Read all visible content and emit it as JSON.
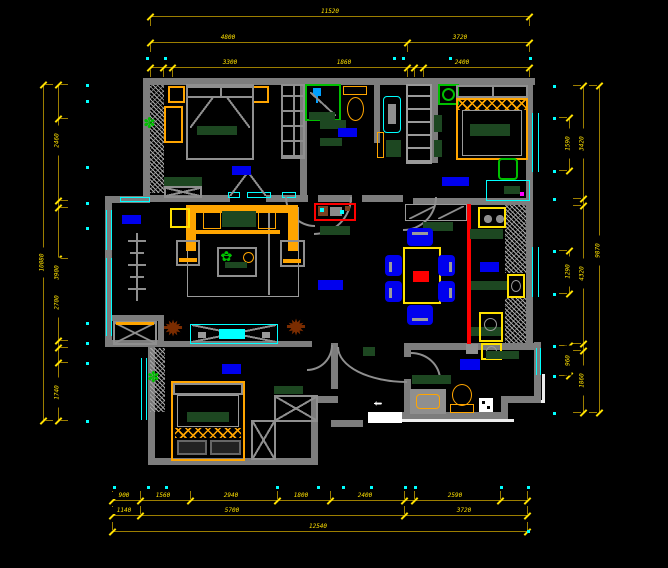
{
  "drawing": {
    "colors": {
      "bg": "#000000",
      "wall": "#7d7d7d",
      "window_cyan": "#00ffff",
      "dim_line": "#9c7e00",
      "dim_text": "#ffe100",
      "label_blue": "#0000ee",
      "furniture_orange": "#ffa500",
      "cushion_dark_green": "#1d4721",
      "plant_green": "#00c000",
      "divider_red": "#ff0000",
      "plant_brown": "#7a2c00",
      "entry_white": "#ffffff"
    },
    "entry": {
      "arrow": "⇦"
    },
    "room_labels": [
      {
        "id": "bedroom-1",
        "x": 232,
        "y": 166,
        "w": 19,
        "h": 9
      },
      {
        "id": "bathroom-1",
        "x": 338,
        "y": 128,
        "w": 19,
        "h": 9
      },
      {
        "id": "bedroom-2",
        "x": 442,
        "y": 177,
        "w": 27,
        "h": 9
      },
      {
        "id": "balcony",
        "x": 122,
        "y": 215,
        "w": 19,
        "h": 9
      },
      {
        "id": "living-room",
        "x": 318,
        "y": 280,
        "w": 25,
        "h": 10
      },
      {
        "id": "kitchen",
        "x": 480,
        "y": 262,
        "w": 19,
        "h": 10
      },
      {
        "id": "bedroom-3",
        "x": 222,
        "y": 364,
        "w": 19,
        "h": 10
      },
      {
        "id": "bathroom-2",
        "x": 460,
        "y": 359,
        "w": 20,
        "h": 11
      }
    ],
    "dims": {
      "h": [
        {
          "y": 16,
          "x1": 150,
          "x2": 529,
          "stub": 1,
          "ticks": [
            150,
            529
          ],
          "labels": [
            {
              "x": 330,
              "t": "11520"
            }
          ]
        },
        {
          "y": 42,
          "x1": 150,
          "x2": 529,
          "stub": 1,
          "ticks": [
            150,
            407,
            529
          ],
          "labels": [
            {
              "x": 228,
              "t": "4800"
            },
            {
              "x": 460,
              "t": "3720"
            }
          ]
        },
        {
          "y": 67,
          "x1": 150,
          "x2": 529,
          "stub": 1,
          "ticks": [
            150,
            163,
            172,
            407,
            414,
            423,
            529
          ],
          "labels": [
            {
              "x": 230,
              "t": "3300"
            },
            {
              "x": 344,
              "t": "1860"
            },
            {
              "x": 462,
              "t": "2400"
            }
          ]
        },
        {
          "y": 500,
          "x1": 112,
          "x2": 527,
          "stub": -1,
          "ticks": [
            112,
            140,
            190,
            277,
            330,
            404,
            414,
            500,
            527
          ],
          "labels": [
            {
              "x": 124,
              "t": "900"
            },
            {
              "x": 163,
              "t": "1560"
            },
            {
              "x": 231,
              "t": "2940"
            },
            {
              "x": 301,
              "t": "1800"
            },
            {
              "x": 365,
              "t": "2400"
            },
            {
              "x": 455,
              "t": "2590"
            }
          ]
        },
        {
          "y": 515,
          "x1": 112,
          "x2": 527,
          "stub": -1,
          "ticks": [
            112,
            140,
            404,
            527
          ],
          "labels": [
            {
              "x": 124,
              "t": "1140"
            },
            {
              "x": 232,
              "t": "5700"
            },
            {
              "x": 464,
              "t": "3720"
            }
          ]
        },
        {
          "y": 531,
          "x1": 112,
          "x2": 527,
          "stub": -1,
          "ticks": [
            112,
            527
          ],
          "labels": [
            {
              "x": 318,
              "t": "12540"
            }
          ]
        }
      ],
      "v": [
        {
          "x": 43,
          "y1": 84,
          "y2": 420,
          "stub": 1,
          "ticks": [
            84,
            420
          ],
          "labels": [
            {
              "y": 262,
              "t": "10080"
            }
          ]
        },
        {
          "x": 58,
          "y1": 84,
          "y2": 420,
          "stub": 1,
          "ticks": [
            84,
            118,
            200,
            207,
            258,
            340,
            347,
            362,
            420
          ],
          "labels": [
            {
              "y": 140,
              "t": "2460"
            },
            {
              "y": 272,
              "t": "3900"
            },
            {
              "y": 302,
              "t": "2700"
            },
            {
              "y": 392,
              "t": "1740"
            }
          ]
        },
        {
          "x": 583,
          "y1": 85,
          "y2": 412,
          "stub": -1,
          "ticks": [
            85,
            198,
            205,
            343,
            350,
            412
          ],
          "labels": [
            {
              "y": 143,
              "t": "3420"
            },
            {
              "y": 273,
              "t": "4320"
            },
            {
              "y": 380,
              "t": "1860"
            }
          ]
        },
        {
          "x": 599,
          "y1": 85,
          "y2": 412,
          "stub": -1,
          "ticks": [
            85,
            412
          ],
          "labels": [
            {
              "y": 250,
              "t": "9870"
            }
          ]
        },
        {
          "x": 569,
          "y1": 117,
          "y2": 170,
          "stub": -1,
          "ticks": [
            117,
            170
          ],
          "labels": [
            {
              "y": 143,
              "t": "1590"
            }
          ]
        },
        {
          "x": 569,
          "y1": 250,
          "y2": 293,
          "stub": -1,
          "ticks": [
            250,
            293
          ],
          "labels": [
            {
              "y": 271,
              "t": "1290"
            }
          ]
        },
        {
          "x": 569,
          "y1": 345,
          "y2": 375,
          "stub": -1,
          "ticks": [
            345,
            375
          ],
          "labels": [
            {
              "y": 360,
              "t": "960"
            }
          ]
        }
      ],
      "dots": [
        [
          146,
          57
        ],
        [
          164,
          57
        ],
        [
          393,
          57
        ],
        [
          402,
          57
        ],
        [
          449,
          57
        ],
        [
          529,
          57
        ],
        [
          86,
          84
        ],
        [
          86,
          100
        ],
        [
          86,
          166
        ],
        [
          86,
          202
        ],
        [
          86,
          227
        ],
        [
          86,
          322
        ],
        [
          86,
          342
        ],
        [
          86,
          362
        ],
        [
          86,
          420
        ],
        [
          553,
          85
        ],
        [
          553,
          117
        ],
        [
          553,
          170
        ],
        [
          553,
          198
        ],
        [
          553,
          250
        ],
        [
          553,
          293
        ],
        [
          553,
          345
        ],
        [
          553,
          375
        ],
        [
          553,
          412
        ],
        [
          113,
          486
        ],
        [
          147,
          486
        ],
        [
          165,
          486
        ],
        [
          276,
          486
        ],
        [
          317,
          486
        ],
        [
          342,
          486
        ],
        [
          370,
          486
        ],
        [
          404,
          486
        ],
        [
          414,
          486
        ],
        [
          500,
          486
        ],
        [
          527,
          486
        ],
        [
          527,
          530
        ]
      ]
    }
  }
}
